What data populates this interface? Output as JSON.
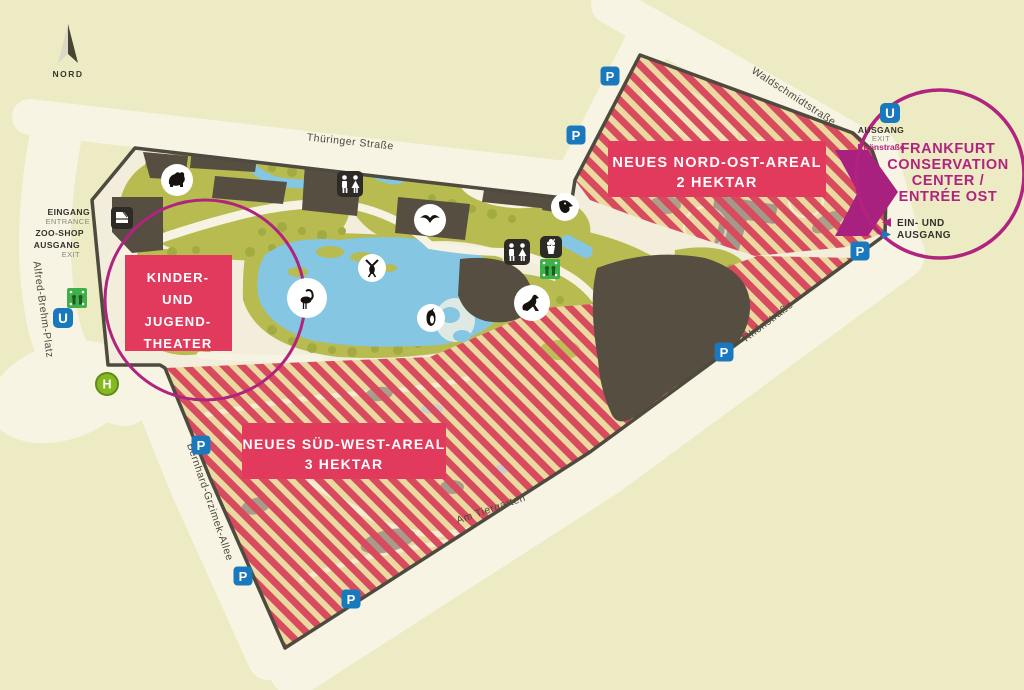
{
  "map": {
    "north_label": "NORD",
    "streets": {
      "thueringer": "Thüringer Straße",
      "waldschmidt": "Waldschmidtstraße",
      "rhoen": "Rhönstraße",
      "alfred": "Alfred-Brehm-Platz",
      "bernhard": "Bernhard-Grzimek-Allee",
      "tiergarten": "Am Tiergarten"
    },
    "west_entrance": {
      "eingang": "EINGANG",
      "entrance": "ENTRANCE",
      "zoo_shop": "ZOO-SHOP",
      "ausgang": "AUSGANG",
      "exit": "EXIT"
    },
    "east_exit": {
      "ausgang": "AUSGANG",
      "exit": "EXIT",
      "street": "Rhönstraße"
    },
    "areas": {
      "nordost": {
        "line1": "NEUES NORD-OST-AREAL",
        "line2": "2 HEKTAR"
      },
      "suedwest": {
        "line1": "NEUES SÜD-WEST-AREAL",
        "line2": "3 HEKTAR"
      },
      "theater": {
        "line1": "KINDER-",
        "line2": "UND",
        "line3": "JUGEND-",
        "line4": "THEATER"
      }
    },
    "conservation_center": {
      "line1": "FRANKFURT",
      "line2": "CONSERVATION",
      "line3": "CENTER /",
      "line4": "ENTRÉE OST",
      "legend_in": "EIN- UND",
      "legend_out": "AUSGANG"
    },
    "badges": {
      "parking": "P",
      "ubahn": "U",
      "tram": "H"
    },
    "colors": {
      "background": "#ecebc3",
      "street": "#f7f4e3",
      "zoo_ground": "#f3eedb",
      "vegetation": "#b7bb50",
      "tree": "#a2aa42",
      "water": "#85c6e2",
      "building": "#554e41",
      "stripe_red": "#d84a5e",
      "stripe_tan": "#ead9a0",
      "label_pink": "#e23a5c",
      "magenta": "#b0237f",
      "blue": "#1a79bd",
      "tram_green": "#85b921"
    }
  }
}
